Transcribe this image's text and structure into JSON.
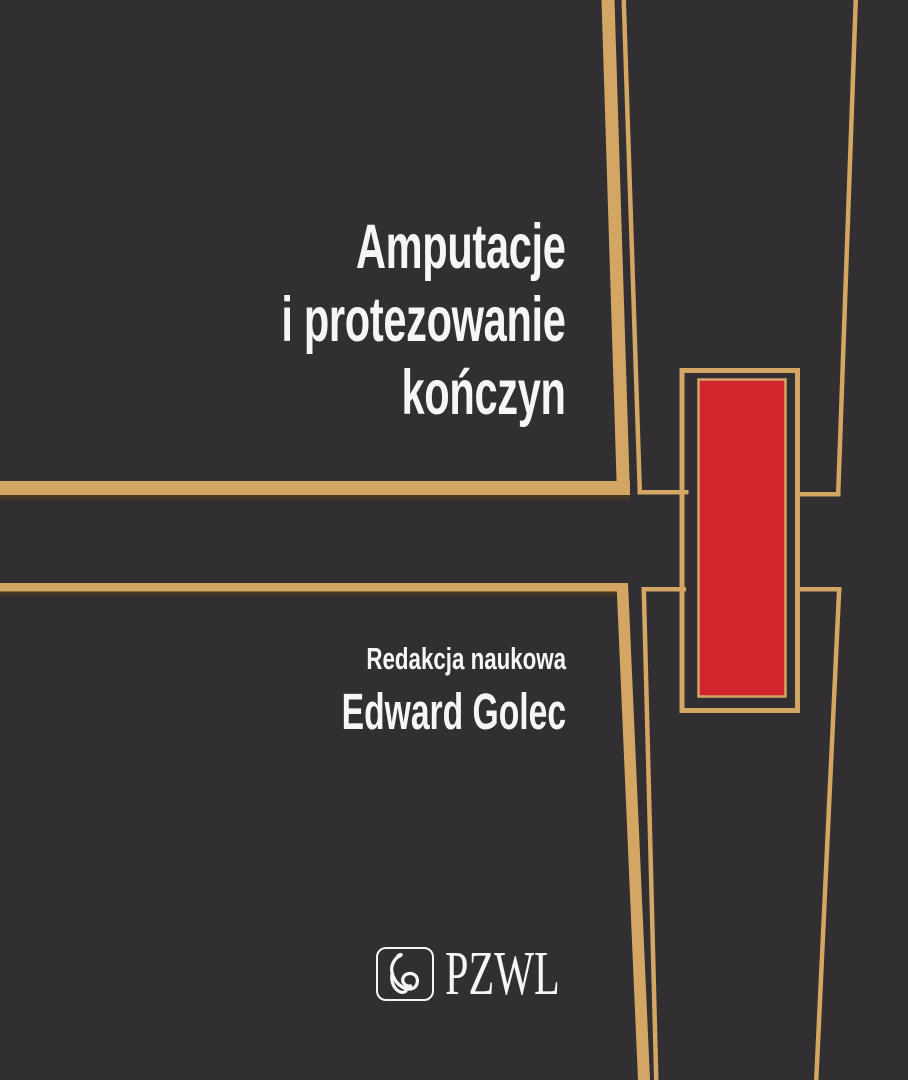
{
  "cover": {
    "title": {
      "line1": "Amputacje",
      "line2": "i protezowanie",
      "line3": "kończyn"
    },
    "editor": {
      "label": "Redakcja naukowa",
      "name": "Edward Golec"
    },
    "publisher": {
      "name": "PZWL",
      "logo_icon": "aesculapius-snake-icon"
    }
  },
  "colors": {
    "background": "#322f33",
    "gold": "#d3a763",
    "gold_shadow": "#463822",
    "red": "#d2242c",
    "text": "#f7f6f4"
  }
}
